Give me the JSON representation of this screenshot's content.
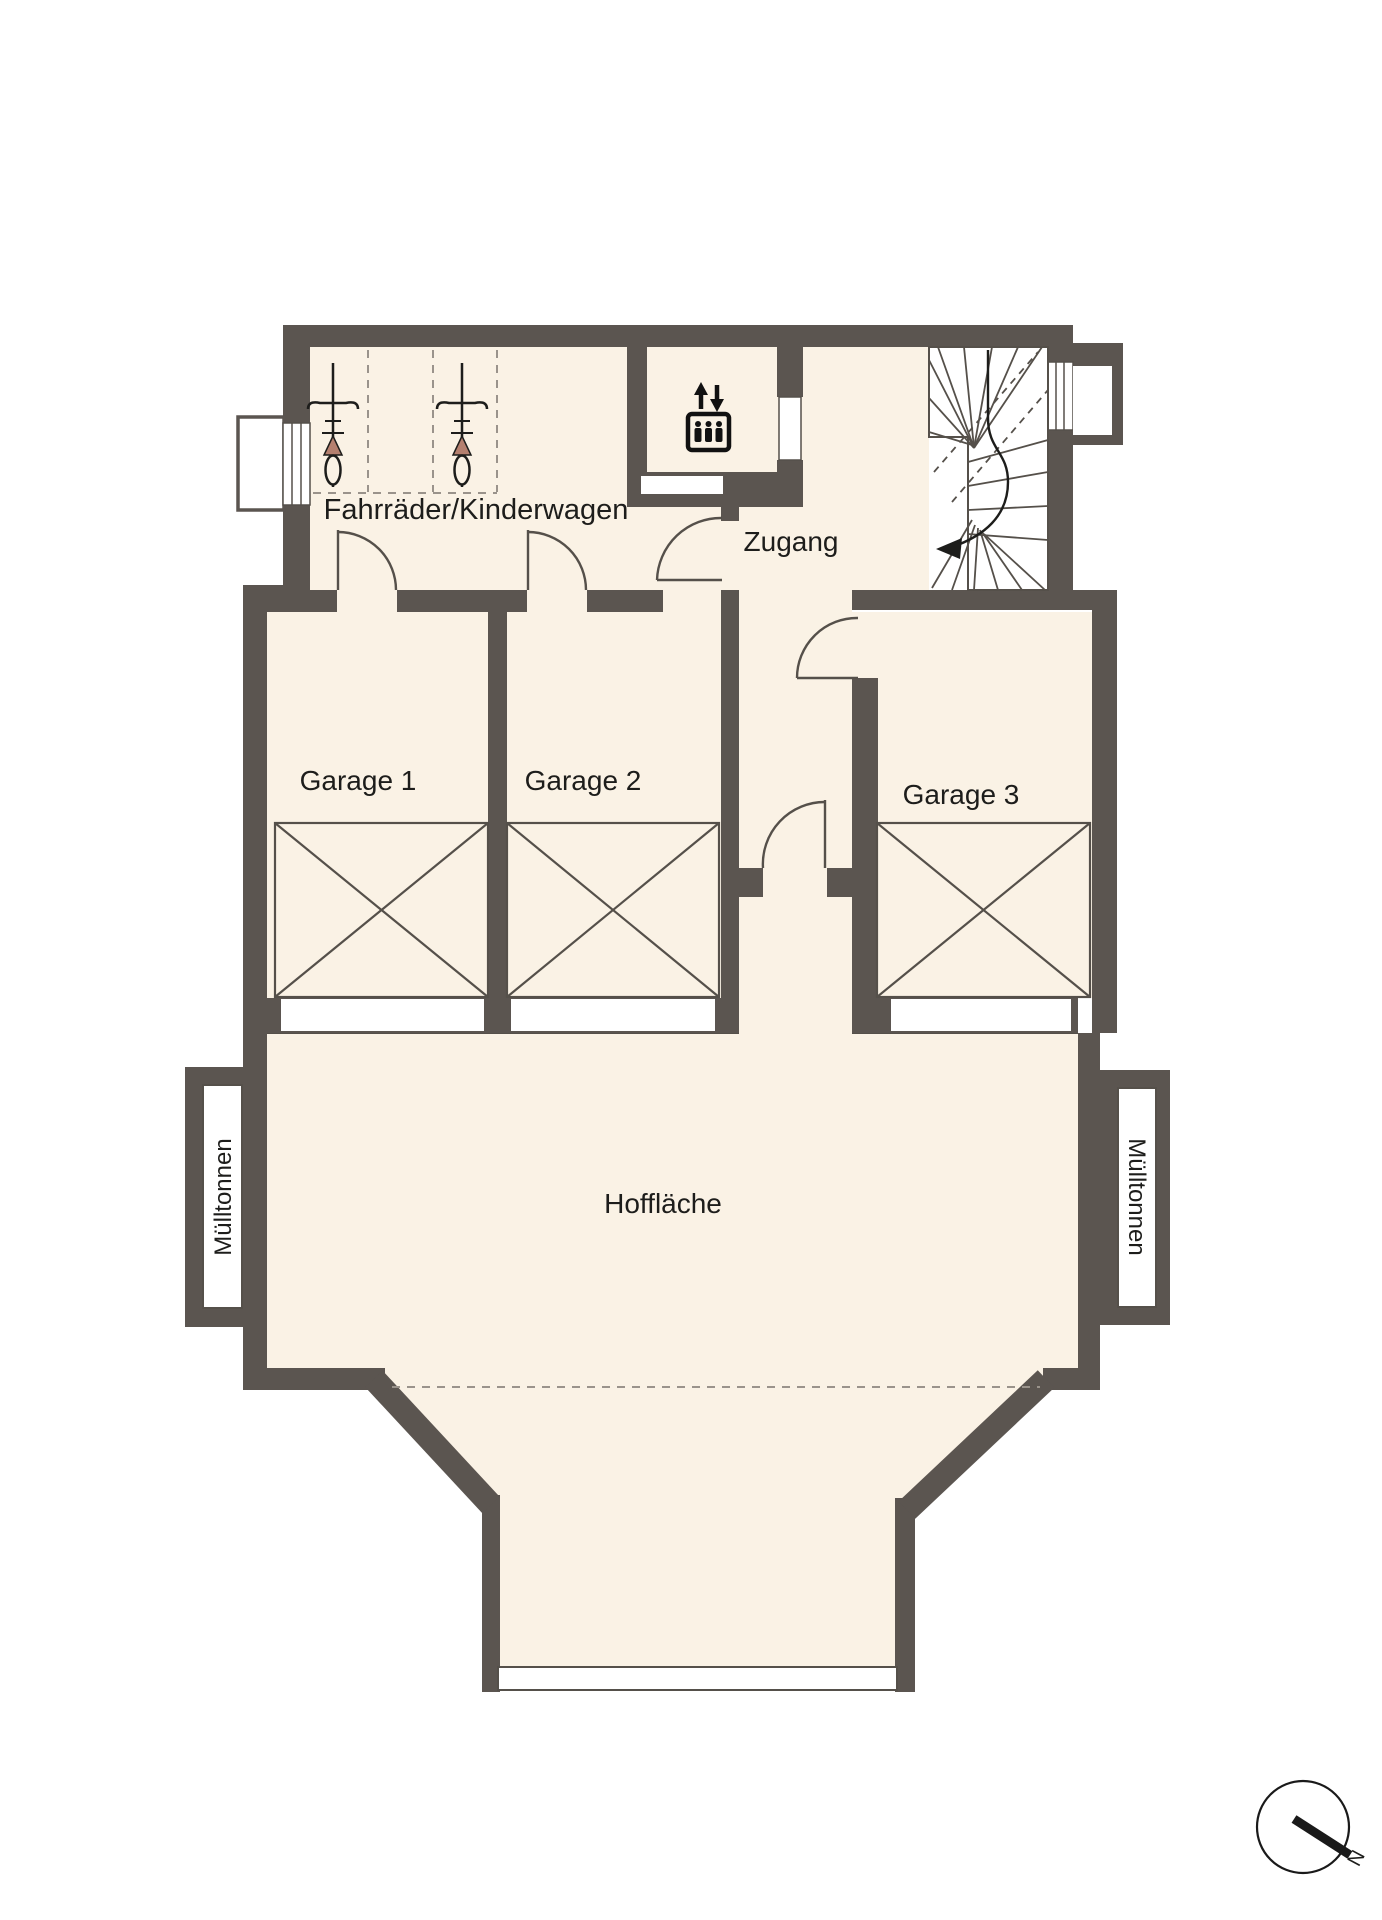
{
  "plan": {
    "title": "Ground floor plan with garages and courtyard",
    "rooms": {
      "bike_storage": "Fahrräder/Kinderwagen",
      "access": "Zugang",
      "garage_1": "Garage 1",
      "garage_2": "Garage 2",
      "garage_3": "Garage 3",
      "courtyard": "Hoffläche",
      "trash_left": "Mülltonnen",
      "trash_right": "Mülltonnen"
    },
    "compass": {
      "north": "N"
    },
    "icons": {
      "elevator": "elevator-icon",
      "bicycle": "bicycle-icon",
      "compass": "north-compass-icon",
      "stairs": "staircase-symbol"
    },
    "colors": {
      "wall": "#5b5550",
      "floor": "#faf2e5",
      "exterior": "#ffffff",
      "line": "#55504a",
      "dashed": "#9a938b",
      "saddle": "#b5806f",
      "text": "#1d1d1b"
    }
  }
}
